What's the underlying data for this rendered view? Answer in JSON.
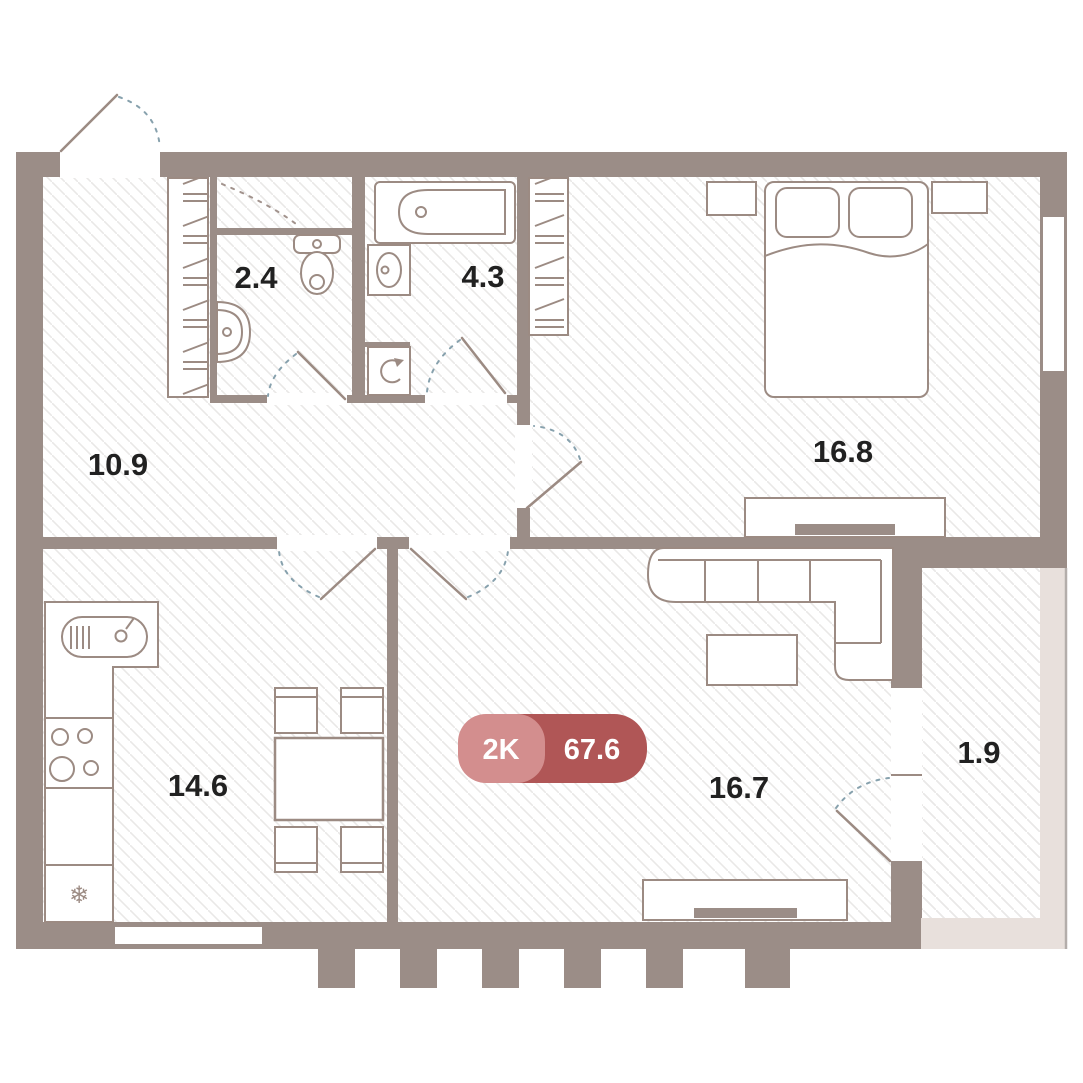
{
  "plan": {
    "badge": {
      "rooms_label": "2K",
      "total_area": "67.6"
    },
    "rooms": [
      {
        "name": "hallway",
        "area": "10.9"
      },
      {
        "name": "wc",
        "area": "2.4"
      },
      {
        "name": "bathroom",
        "area": "4.3"
      },
      {
        "name": "bedroom",
        "area": "16.8"
      },
      {
        "name": "kitchen",
        "area": "14.6"
      },
      {
        "name": "living-room",
        "area": "16.7"
      },
      {
        "name": "balcony",
        "area": "1.9"
      }
    ],
    "icons": {
      "fridge_snowflake": "❄"
    },
    "colors": {
      "wall": "#9b8d87",
      "furniture_line": "#9c8b83",
      "door_swing_arc": "#87a1ad",
      "balcony_exterior": "#e8e0dc",
      "balcony_edge_line": "#b3adaa",
      "floor_hatch": "#e9e8e7",
      "badge_rooms_bg": "#d38e8e",
      "badge_area_bg": "#b05656",
      "badge_text": "#ffffff",
      "room_label_text": "#212121"
    }
  }
}
